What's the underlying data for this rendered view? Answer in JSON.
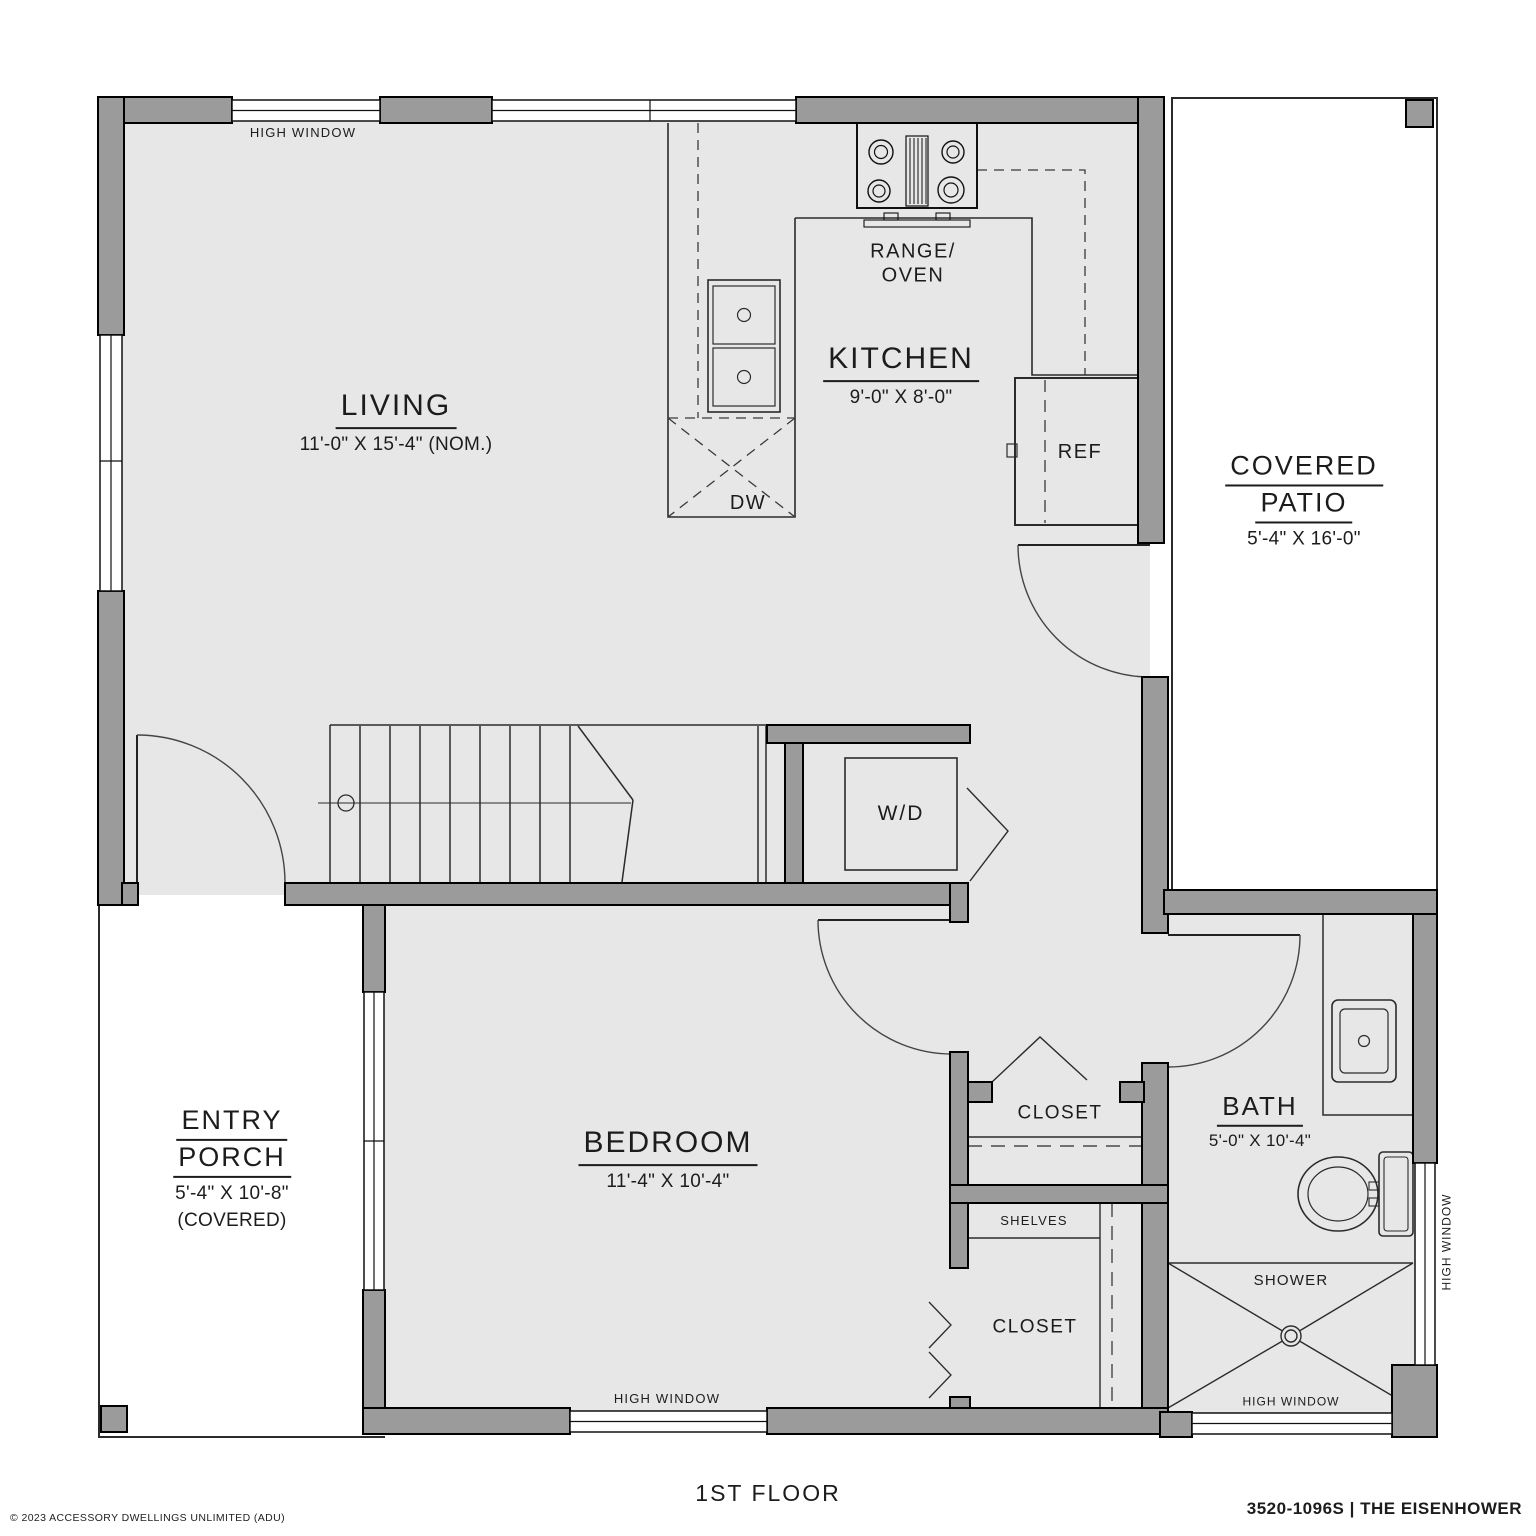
{
  "canvas": {
    "width": 1536,
    "height": 1536
  },
  "colors": {
    "wall": "#9b9b9b",
    "floor": "#e7e7e7",
    "line": "#2b2b2b",
    "text": "#1c1c1c",
    "background": "#ffffff"
  },
  "rooms": {
    "living": {
      "name": "LIVING",
      "dims": "11'-0\" X 15'-4\" (NOM.)"
    },
    "kitchen": {
      "name": "KITCHEN",
      "dims": "9'-0\" X 8'-0\""
    },
    "covered_patio": {
      "line1": "COVERED",
      "line2": "PATIO",
      "dims": "5'-4\" X 16'-0\""
    },
    "entry_porch": {
      "line1": "ENTRY",
      "line2": "PORCH",
      "dims": "5'-4\" X 10'-8\"",
      "note": "(COVERED)"
    },
    "bedroom": {
      "name": "BEDROOM",
      "dims": "11'-4\" X 10'-4\""
    },
    "bath": {
      "name": "BATH",
      "dims": "5'-0\" X 10'-4\""
    }
  },
  "fixtures": {
    "range_line1": "RANGE/",
    "range_line2": "OVEN",
    "ref": "REF",
    "dw": "DW",
    "wd": "W/D",
    "closet_upper": "CLOSET",
    "closet_lower": "CLOSET",
    "shelves": "SHELVES",
    "shower": "SHOWER"
  },
  "window_labels": {
    "top": "HIGH WINDOW",
    "bedroom": "HIGH WINDOW",
    "bath_south": "HIGH WINDOW",
    "bath_east": "HIGH WINDOW"
  },
  "footer": {
    "floor_title": "1ST FLOOR",
    "plan_code": "3520-1096S | THE EISENHOWER",
    "copyright": "© 2023 ACCESSORY DWELLINGS UNLIMITED (ADU)"
  }
}
